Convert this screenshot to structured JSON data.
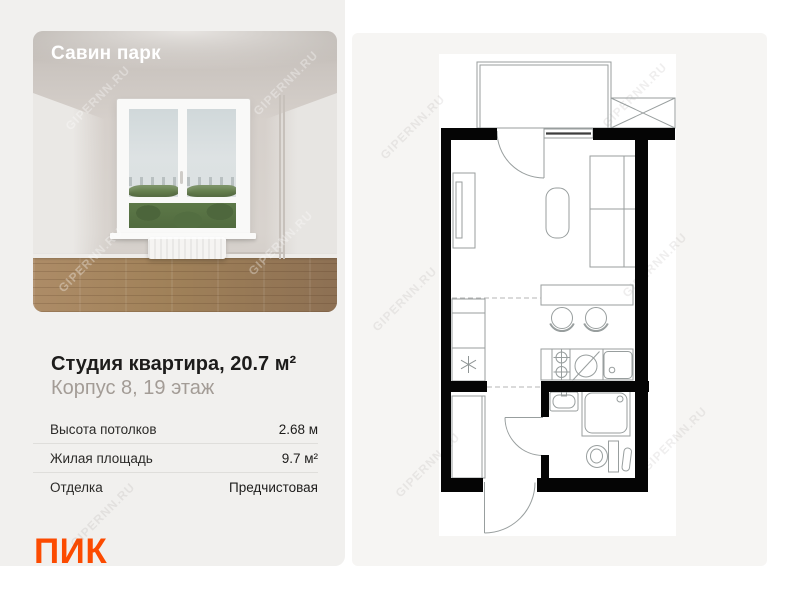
{
  "photo": {
    "title": "Савин парк"
  },
  "listing": {
    "title": "Студия квартира, 20.7 м²",
    "subtitle": "Корпус 8, 19 этаж"
  },
  "specs": {
    "rows": [
      {
        "label": "Высота потолков",
        "value": "2.68 м"
      },
      {
        "label": "Жилая площадь",
        "value": "9.7 м²"
      },
      {
        "label": "Отделка",
        "value": "Предчистовая"
      }
    ]
  },
  "brand": {
    "logo_text": "ПИК",
    "accent_color": "#FC4B01"
  },
  "watermark": {
    "text": "GIPERNN.RU"
  },
  "floor_plan": {
    "line_color": "#989e9e",
    "wall_color": "#050505",
    "icons": {
      "fridge": "snowflake-icon",
      "stove": "two-burner-icon",
      "washing_machine": "circle-slash-icon",
      "elevator_shaft": "crossed-box-icon"
    }
  }
}
